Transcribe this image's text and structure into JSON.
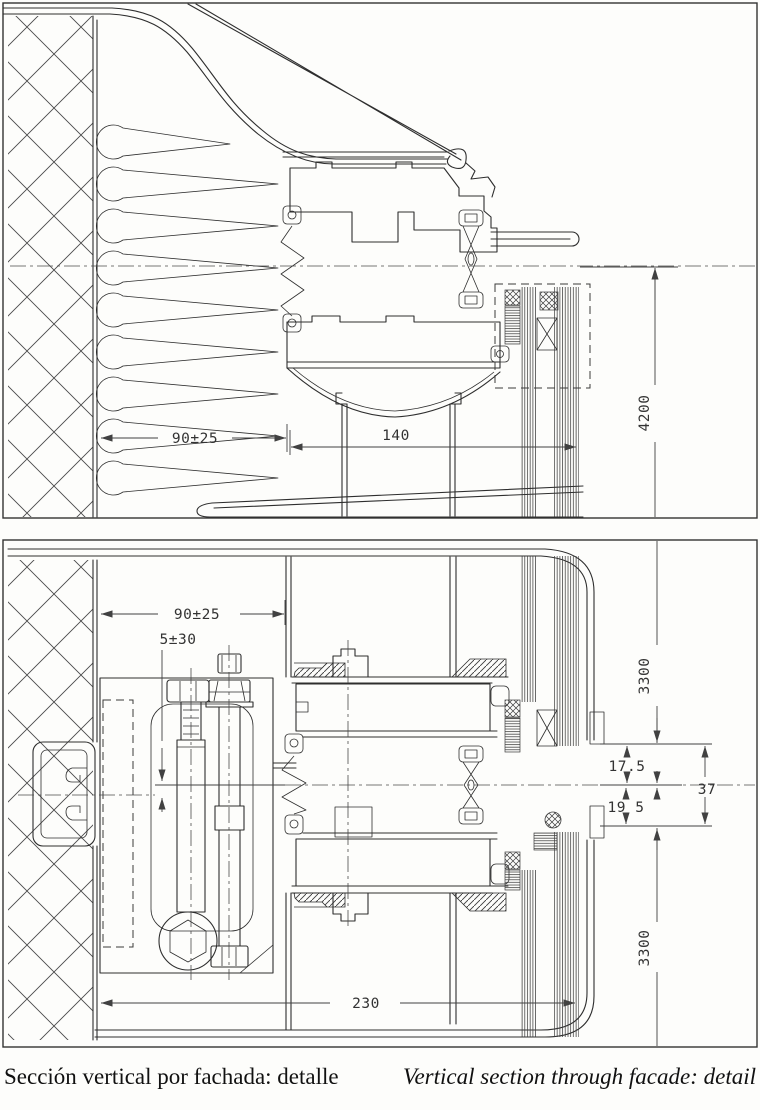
{
  "caption": {
    "es": "Sección vertical por fachada: detalle",
    "en": "Vertical section through facade: detail"
  },
  "top_drawing": {
    "name": "parapet / head detail",
    "dims": {
      "insulation_width": "90±25",
      "mullion_depth": "140",
      "module_height": "4200"
    }
  },
  "bottom_drawing": {
    "name": "transom / anchor detail",
    "dims": {
      "insulation_width": "90±25",
      "adjustment": "5±30",
      "upper_module_height": "3300",
      "upper_offset": "17.5",
      "lower_offset": "19 5",
      "total_offset": "37",
      "lower_module_height": "3300",
      "anchor_depth": "230"
    }
  }
}
